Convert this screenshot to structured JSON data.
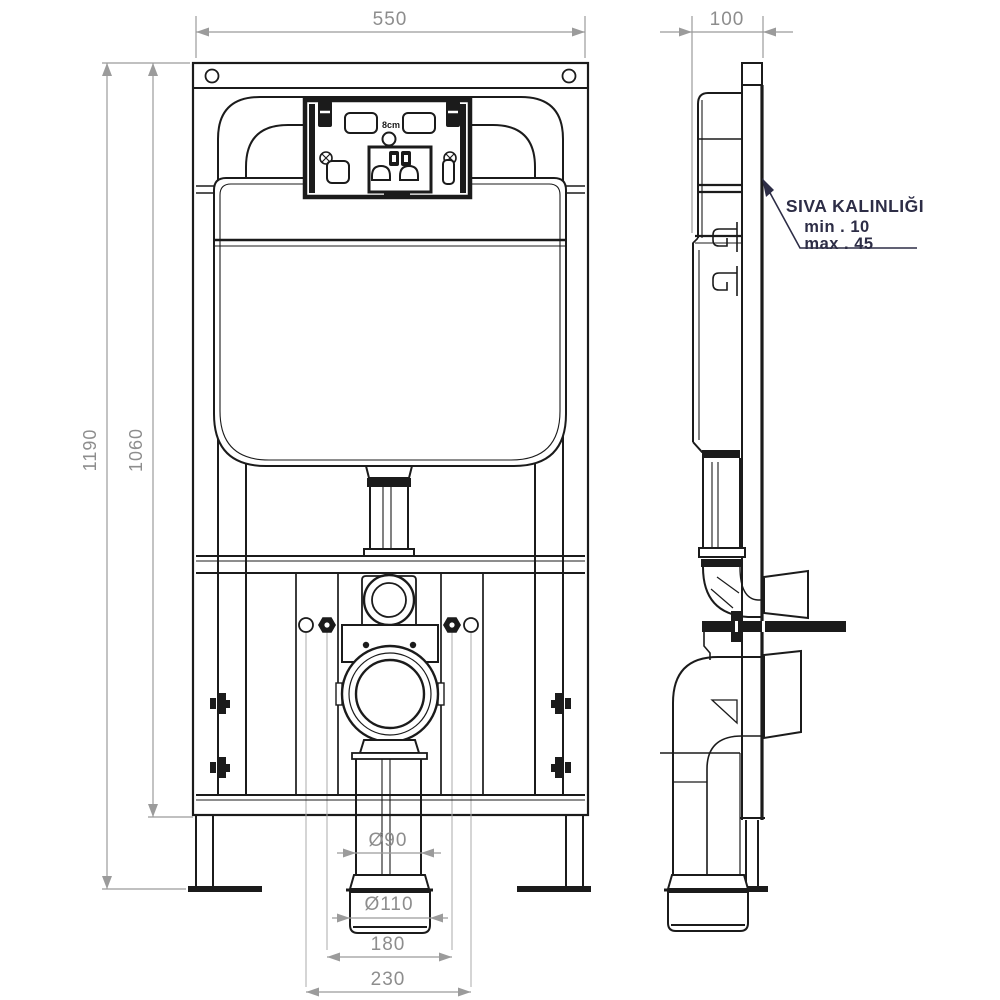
{
  "drawing": {
    "type": "technical-installation-drawing",
    "subject": "concealed-cistern-wc-frame",
    "dimensions": {
      "frame_width": "550",
      "frame_depth": "100",
      "frame_height": "1190",
      "height_to_bottom_rail": "1060",
      "drain_pipe_diameter": "Ø90",
      "drain_coupling_diameter": "Ø110",
      "fixing_bolt_spacing": "180",
      "outer_bolt_spacing": "230",
      "cistern_depth_label": "8cm"
    },
    "plaster_note": {
      "title": "SIVA KALINLIĞI",
      "min": "min .  10",
      "max": "max .  45"
    },
    "colors": {
      "line": "#1b1b1b",
      "dimension_line": "#9b9b9b",
      "dimension_text": "#8d8d8d",
      "note_text": "#2d2d46",
      "background": "#ffffff"
    }
  }
}
